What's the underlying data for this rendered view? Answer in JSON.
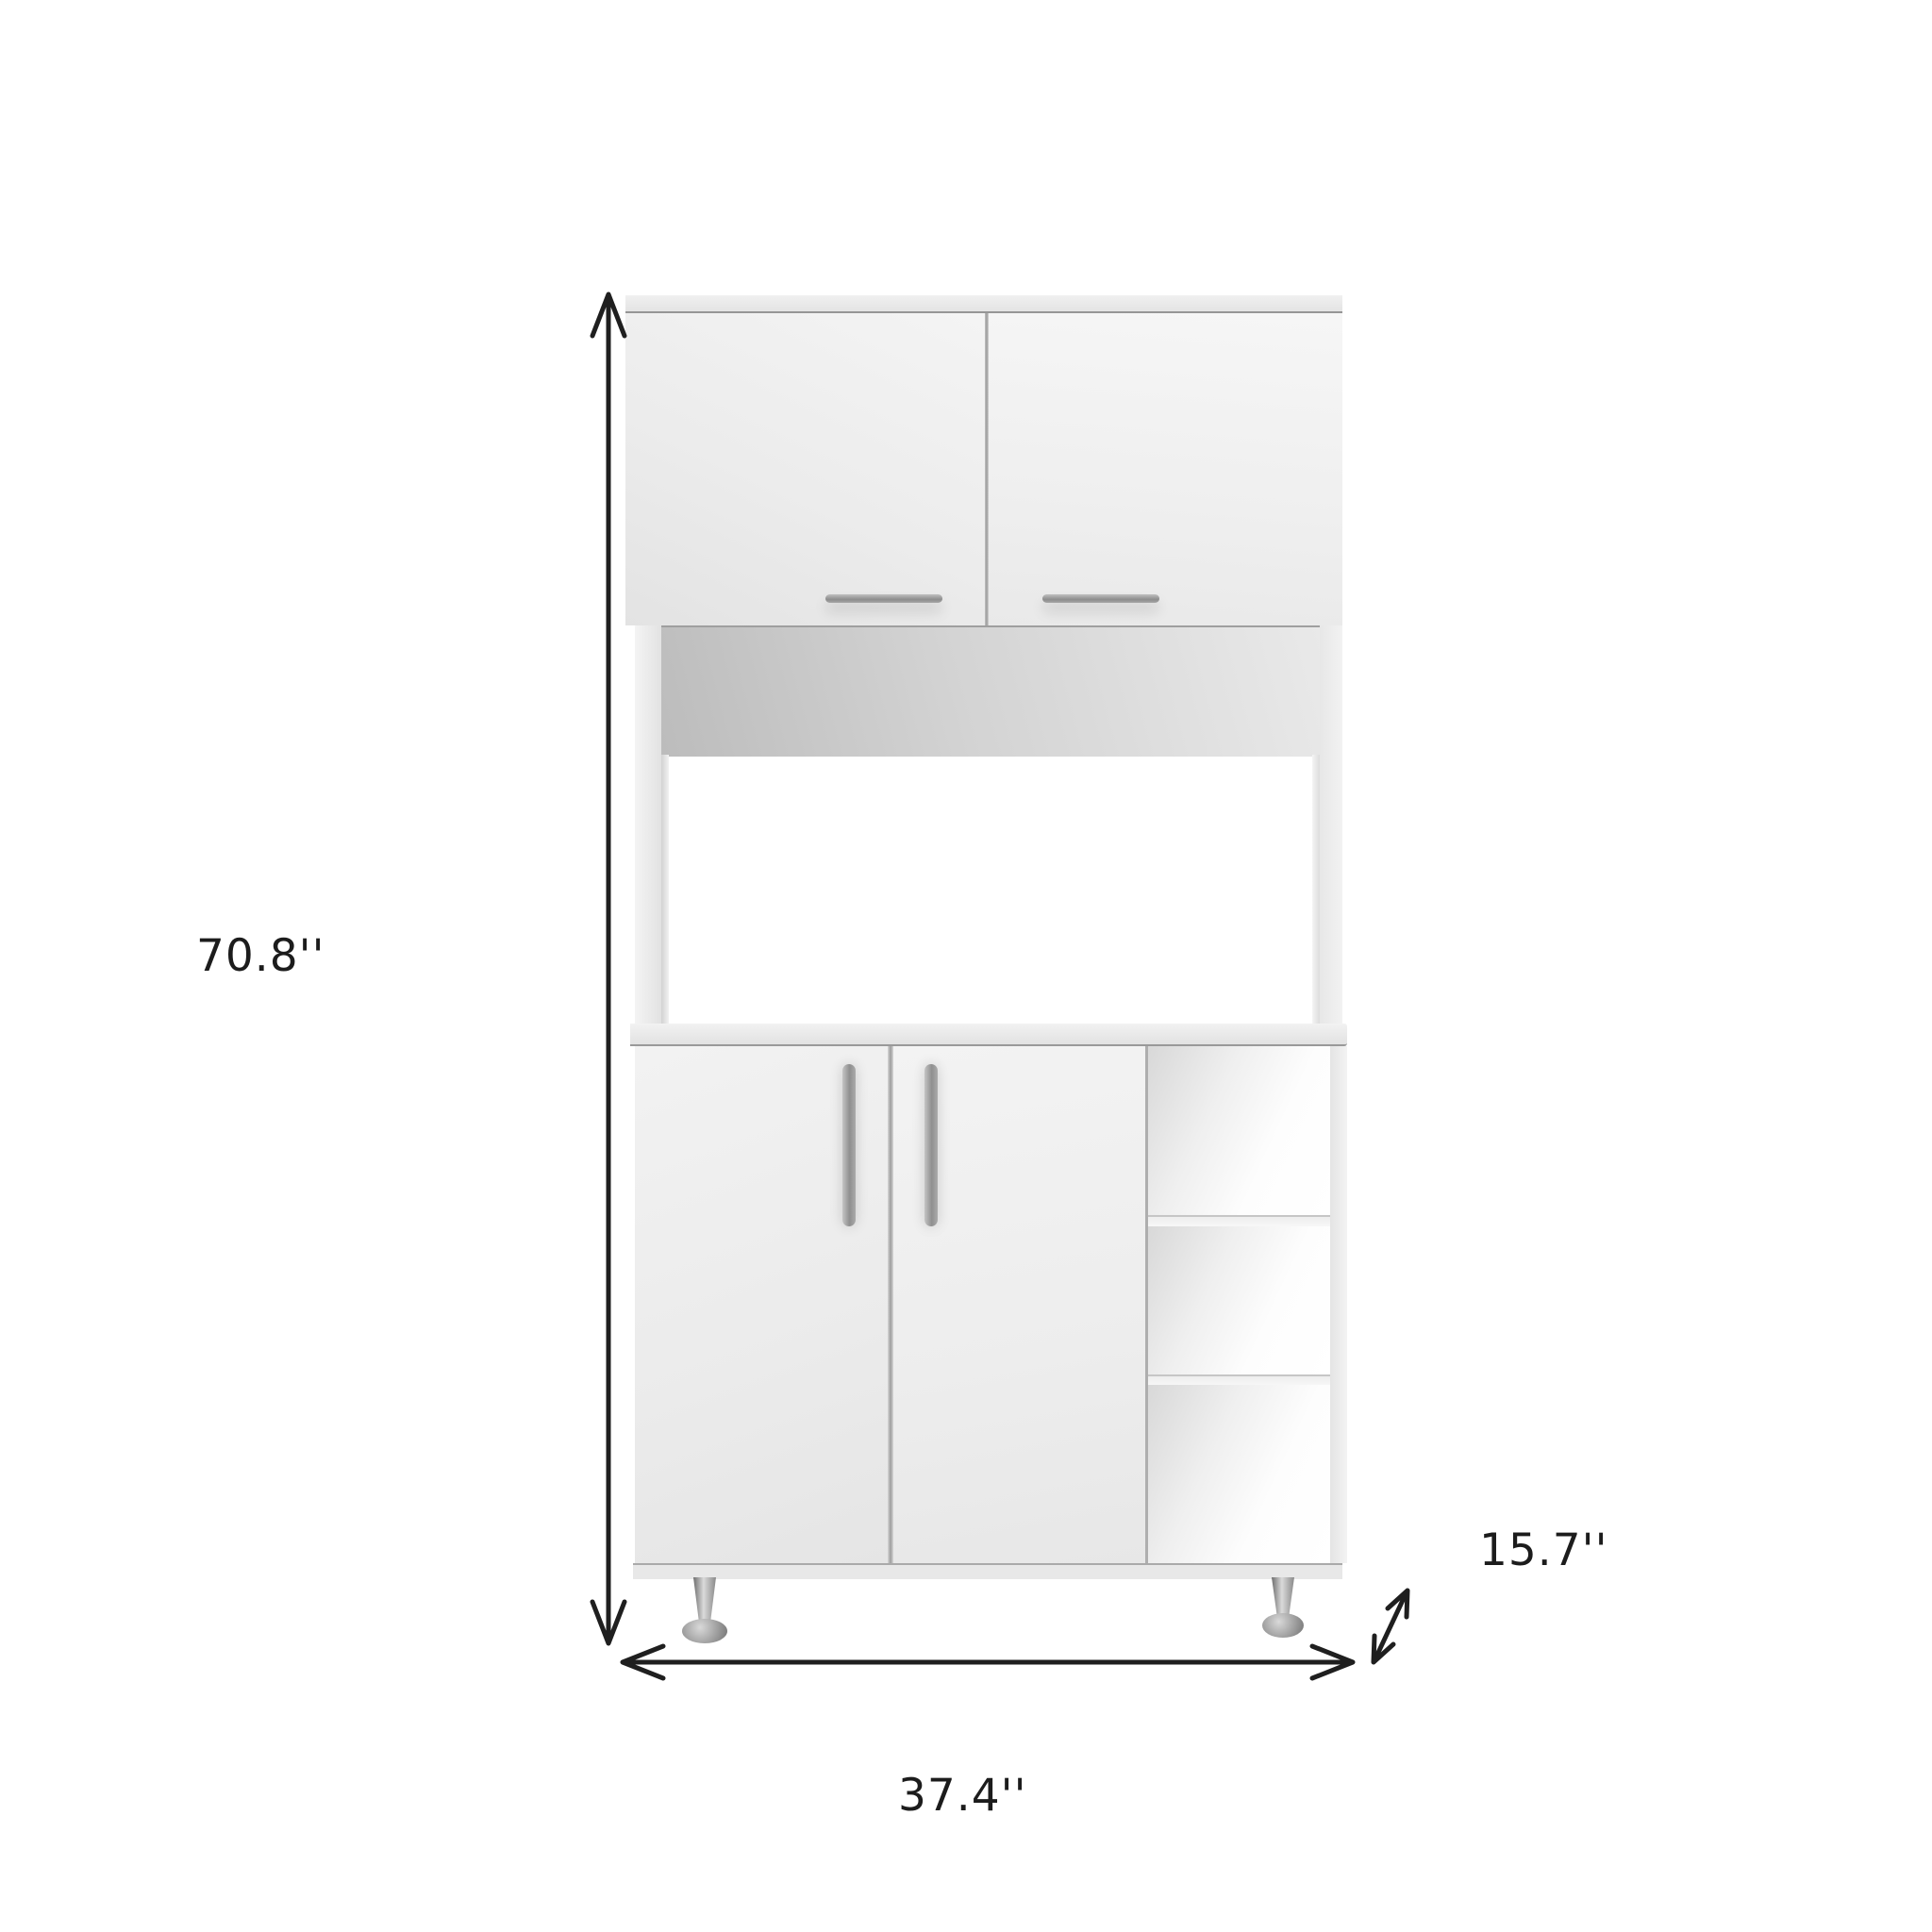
{
  "image": {
    "kind": "product-dimension-diagram",
    "background_color": "#ffffff"
  },
  "product": {
    "name": "white-pantry-cabinet-with-microwave-hutch",
    "body_color": "#efefef",
    "handle_color": "#919191",
    "leg_color": "#9a9a9a",
    "upper_door_count": 2,
    "lower_door_count": 2,
    "open_shelf_count": 3,
    "leg_count": 2
  },
  "annotations": {
    "line_color": "#1f1f1f",
    "height_label": "70.8''",
    "width_label": "37.4''",
    "depth_label": "15.7''"
  }
}
